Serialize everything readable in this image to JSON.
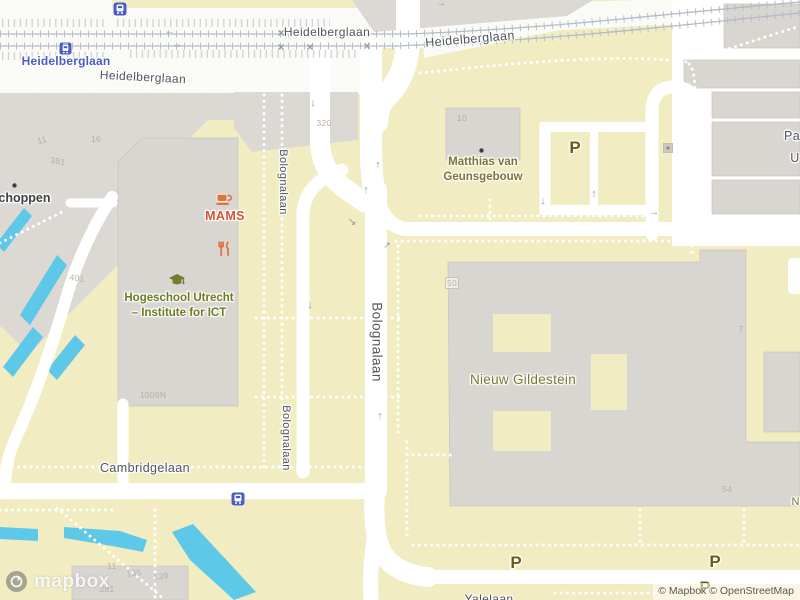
{
  "map": {
    "attribution": {
      "text": "© Mapbox © OpenStreetMap",
      "logo_word": "mapbox"
    },
    "colors": {
      "land": "#f2ecc2",
      "building": "#d9d5d0",
      "water": "#5ec8e9",
      "road": "#ffffff",
      "street_label": "#50545b",
      "poi_olive": "#6b7a22",
      "poi_orange": "#d2543a",
      "poi_icon_orange": "#e1743e",
      "poi_icon_olive": "#747c2b",
      "transit_blue": "#4a5cc0",
      "parking_brown": "#6d5b16"
    },
    "labels": [
      {
        "cls": "street",
        "t": "Heidelberglaan",
        "x": 327,
        "y": 25
      },
      {
        "cls": "street",
        "t": "Heidelberglaan",
        "x": 143,
        "y": 70,
        "rot": 3
      },
      {
        "cls": "street",
        "t": "Heidelberglaan",
        "x": 470,
        "y": 32,
        "rot": -5,
        "s": 12.5
      },
      {
        "cls": "street",
        "t": "Cambridgelaan",
        "x": 145,
        "y": 461,
        "s": 12.5
      },
      {
        "cls": "street",
        "t": "Bolognalaan",
        "x": 283,
        "y": 182,
        "rot": 90,
        "s": 11
      },
      {
        "cls": "street",
        "t": "Bolognalaan",
        "x": 377,
        "y": 342,
        "rot": 90,
        "s": 13.5
      },
      {
        "cls": "street",
        "t": "Bolognalaan",
        "x": 286,
        "y": 438,
        "rot": 90,
        "s": 11
      },
      {
        "cls": "street",
        "t": "Yalelaan",
        "x": 489,
        "y": 592,
        "s": 12
      },
      {
        "cls": "street",
        "t": "Pa",
        "x": 792,
        "y": 129,
        "s": 12.5
      },
      {
        "cls": "street",
        "t": "U",
        "x": 795,
        "y": 151,
        "s": 12.5
      },
      {
        "cls": "transit",
        "t": "Heidelberglaan",
        "x": 66,
        "y": 54
      },
      {
        "cls": "school",
        "lines": [
          "Hogeschool Utrecht",
          "– Institute for ICT"
        ],
        "x": 179,
        "y": 291
      },
      {
        "cls": "cafe",
        "t": "MAMS",
        "x": 225,
        "y": 209
      },
      {
        "cls": "bldg",
        "lines": [
          "Matthias van",
          "Geunsgebouw"
        ],
        "x": 483,
        "y": 155
      },
      {
        "cls": "ng",
        "t": "Nieuw Gildestein",
        "x": 523,
        "y": 372
      },
      {
        "cls": "ng",
        "t": "Ni",
        "x": 797,
        "y": 496,
        "s": 11
      },
      {
        "cls": "shop",
        "t": "schoppen",
        "x": 21,
        "y": 191
      },
      {
        "cls": "parking",
        "t": "P",
        "x": 575,
        "y": 138
      },
      {
        "cls": "parking",
        "t": "P",
        "x": 516,
        "y": 553
      },
      {
        "cls": "parking",
        "t": "P",
        "x": 715,
        "y": 552
      },
      {
        "cls": "parking",
        "t": "P",
        "x": 705,
        "y": 578
      }
    ],
    "house_numbers": [
      {
        "t": "11",
        "x": 42,
        "y": 135,
        "rot": -15
      },
      {
        "t": "381",
        "x": 58,
        "y": 156,
        "rot": 8
      },
      {
        "t": "16",
        "x": 96,
        "y": 134
      },
      {
        "t": "320",
        "x": 324,
        "y": 118
      },
      {
        "t": "401",
        "x": 77,
        "y": 273,
        "rot": 8
      },
      {
        "t": "1008N",
        "x": 153,
        "y": 390
      },
      {
        "t": "10",
        "x": 462,
        "y": 113
      },
      {
        "t": "50",
        "x": 452,
        "y": 277,
        "boxed": true
      },
      {
        "t": "7",
        "x": 741,
        "y": 324
      },
      {
        "t": "54",
        "x": 727,
        "y": 484
      },
      {
        "t": "11",
        "x": 112,
        "y": 561
      },
      {
        "t": "135",
        "x": 134,
        "y": 568,
        "rot": -6
      },
      {
        "t": "139",
        "x": 161,
        "y": 571,
        "rot": -6
      },
      {
        "t": "281",
        "x": 107,
        "y": 584
      }
    ],
    "arrows": [
      {
        "g": "↓",
        "x": 313,
        "y": 97
      },
      {
        "g": "↓",
        "x": 310,
        "y": 299
      },
      {
        "g": "↑",
        "x": 380,
        "y": 410
      },
      {
        "g": "↑",
        "x": 378,
        "y": 159
      },
      {
        "g": "↑",
        "x": 366,
        "y": 184
      },
      {
        "g": "↘",
        "x": 352,
        "y": 215
      },
      {
        "g": "↗",
        "x": 387,
        "y": 240,
        "s": 9
      },
      {
        "g": "↓",
        "x": 543,
        "y": 195
      },
      {
        "g": "↑",
        "x": 594,
        "y": 188
      },
      {
        "g": "→",
        "x": 654,
        "y": 206
      },
      {
        "g": "←",
        "x": 170,
        "y": 26,
        "s": 10
      },
      {
        "g": "→",
        "x": 177,
        "y": 39,
        "s": 10
      },
      {
        "g": "→",
        "x": 441,
        "y": -2,
        "s": 10
      }
    ],
    "crossings": [
      {
        "x": 281,
        "y": 26
      },
      {
        "x": 281,
        "y": 40
      },
      {
        "x": 310,
        "y": 40
      },
      {
        "x": 367,
        "y": 39
      }
    ],
    "icons": [
      {
        "type": "tram-station-icon",
        "x": 113,
        "y": 2
      },
      {
        "type": "train-station-icon",
        "x": 59,
        "y": 42
      },
      {
        "type": "bus-stop-icon",
        "x": 231,
        "y": 492
      },
      {
        "type": "cafe-icon",
        "x": 216,
        "y": 192
      },
      {
        "type": "restaurant-icon",
        "x": 218,
        "y": 241
      },
      {
        "type": "college-icon",
        "x": 168,
        "y": 273
      },
      {
        "type": "poi-dot-icon",
        "x": 479,
        "y": 148
      },
      {
        "type": "poi-dot-icon",
        "x": 12,
        "y": 183
      },
      {
        "type": "generic-poi-icon",
        "x": 663,
        "y": 143
      }
    ]
  }
}
